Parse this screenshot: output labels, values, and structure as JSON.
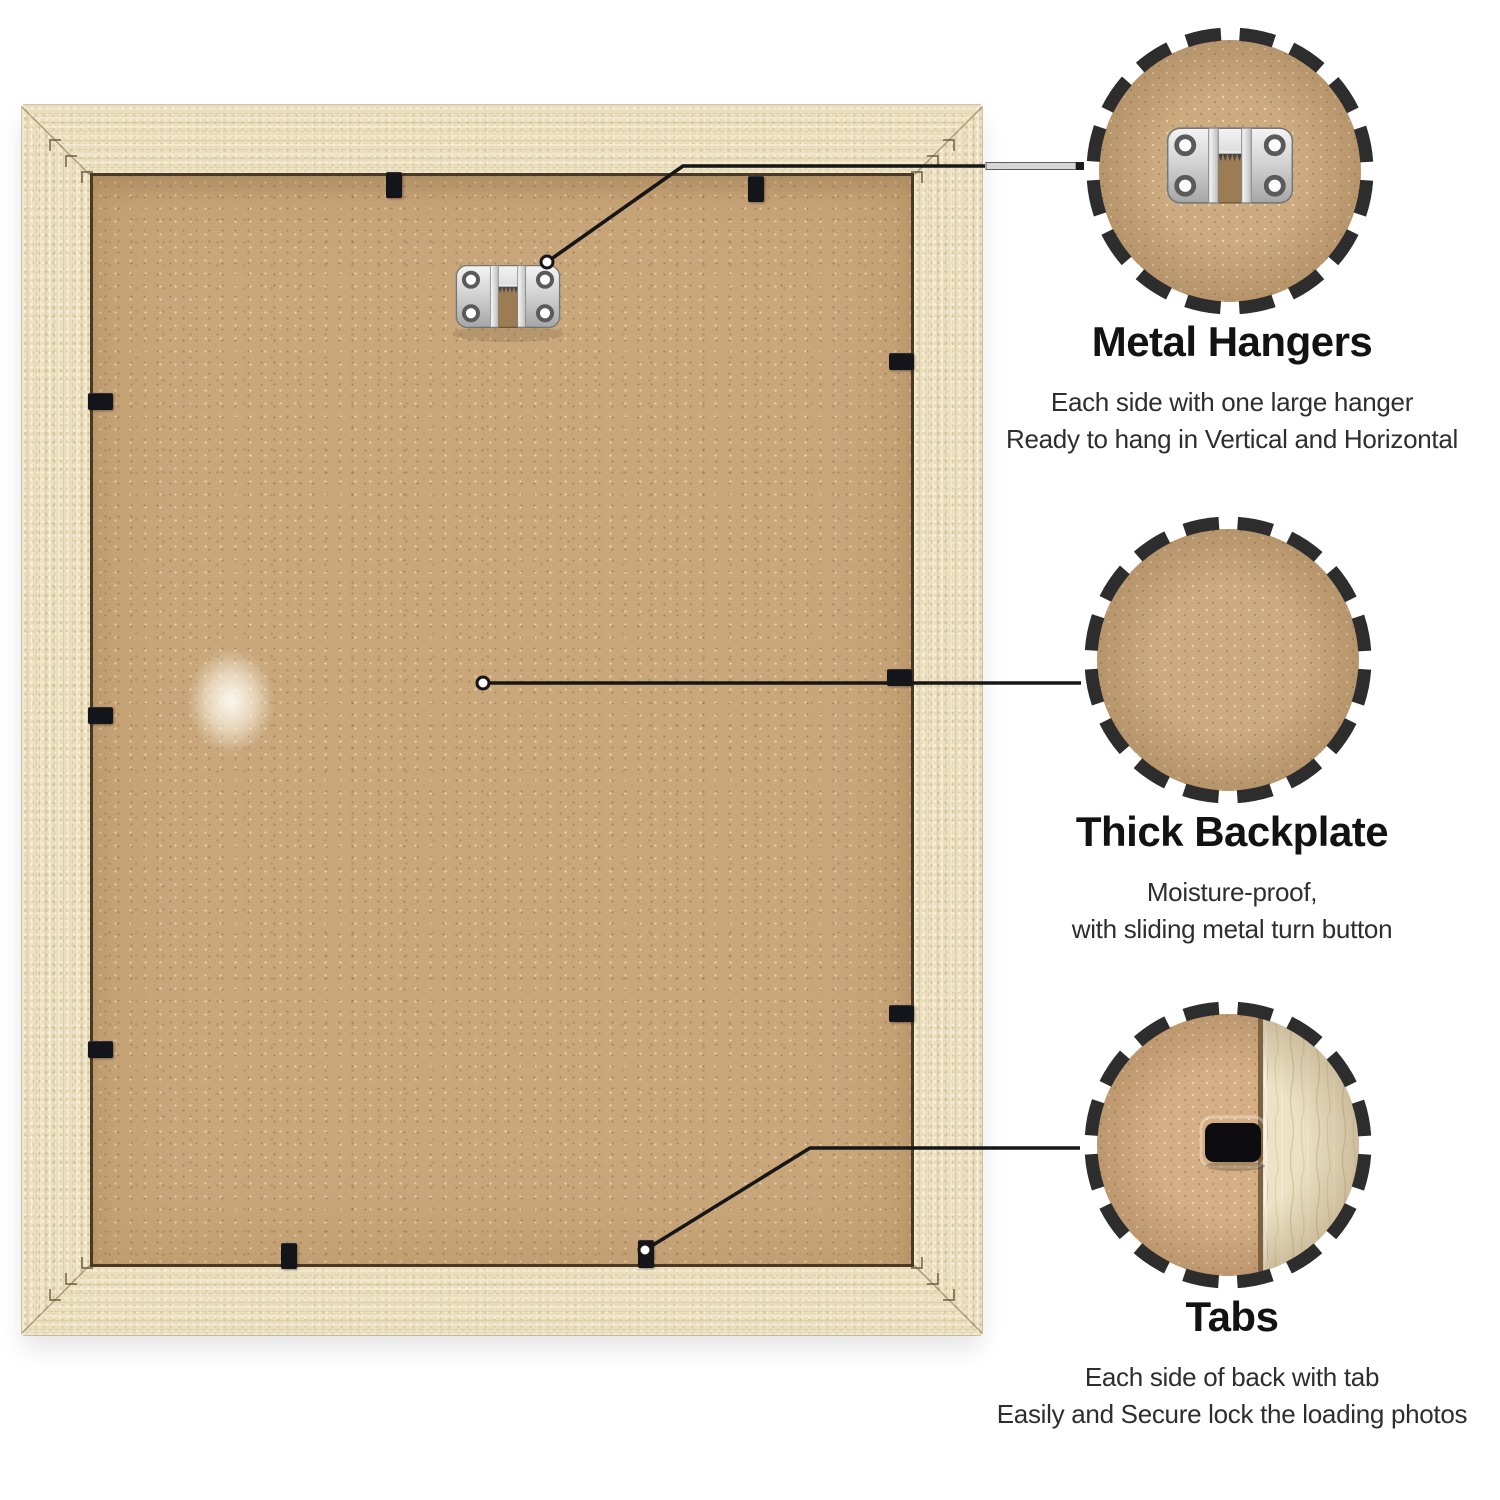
{
  "callouts": [
    {
      "id": "metal-hangers",
      "icon": "metal-hanger-icon",
      "title": "Metal Hangers",
      "lines": [
        "Each side with one large hanger",
        "Ready to hang in Vertical and Horizontal"
      ]
    },
    {
      "id": "thick-backplate",
      "icon": "backplate-texture-icon",
      "title": "Thick Backplate",
      "lines": [
        "Moisture-proof,",
        "with sliding metal turn button"
      ]
    },
    {
      "id": "tabs",
      "icon": "tab-slot-icon",
      "title": "Tabs",
      "lines": [
        "Each side of back with tab",
        "Easily and Secure lock the loading photos"
      ]
    }
  ],
  "colors": {
    "dash": "#2d2d2d",
    "line": "#161616",
    "title": "#121212",
    "text": "#2e2e2e",
    "tab": "#14141b",
    "cardboard": "#c9a77b",
    "cardboard2": "#cdab81",
    "cardboard3": "#d5ae85",
    "wood": "#e9ddbb",
    "wood2": "#ece3c6",
    "metal": "#d8d8d8"
  }
}
